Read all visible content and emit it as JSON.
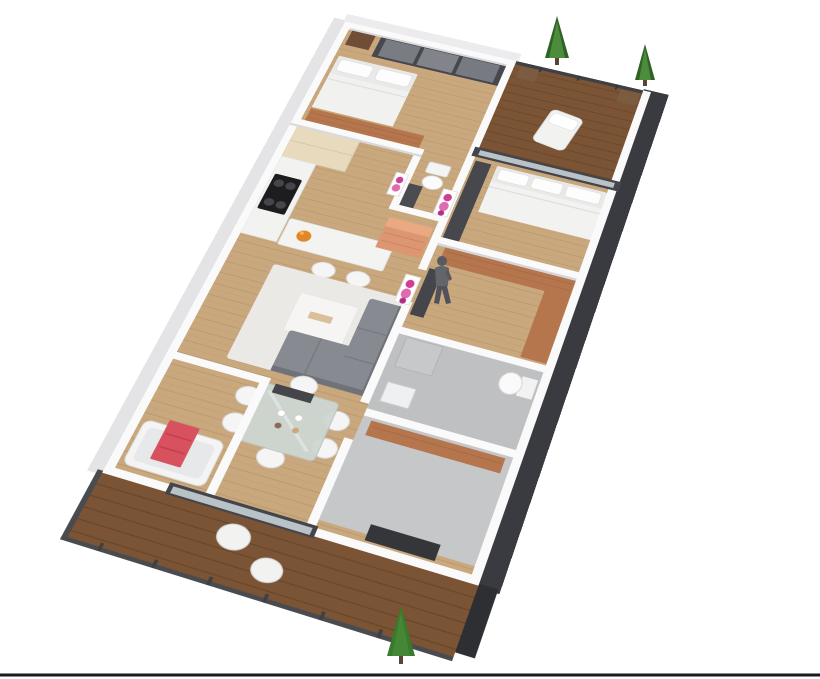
{
  "scene": {
    "type": "isometric-3d-floor-plan-render",
    "background": "#ffffff",
    "description": "Dollhouse-view 3D floor plan of an apartment: open kitchen-living-dining zone, two bedrooms, study, two bathrooms, WC, upper balcony with trees and long lower timber terrace"
  },
  "palette": {
    "floor_wood": "#c9a87e",
    "floor_plank_line": "#a98a62",
    "deck_wood": "#7a5434",
    "deck_plank_line": "#5d3d22",
    "wall_cap": "#fafafa",
    "wall_face_light": "#e4e4e7",
    "wall_face_top": "#ececef",
    "exterior_dark": "#3a3b40",
    "deck_fascia_dark": "#2e2f33",
    "railing_dark": "#4a4b4f",
    "panel_dark": "#47484d",
    "mirror_gray": "#7a7c84",
    "glass_pale": "#cdd8dd",
    "door_frame_dark": "#44454a",
    "gray_floor": "#bfc0c2",
    "gray_floor_2": "#c6c7c9",
    "cream_cabinet": "#e7dabd",
    "counter_white": "#f2f2f1",
    "cooktop_black": "#1d1d1f",
    "burner_gray": "#45464a",
    "island_white": "#f3f3f2",
    "rug": "#ebe9e5",
    "coffee_table": "#f6f5f3",
    "table_deco": "#d9c09a",
    "sofa_gray": "#878a90",
    "sofa_gray_dark": "#6f7278",
    "dining_glass": "#cdd7d2",
    "chair_white": "#f5f5f5",
    "copper_sideboard": "#dd9672",
    "copper_sideboard_top": "#eaa981",
    "art_magenta": "#cf3f96",
    "art_magenta_2": "#e06ab0",
    "art_magenta_3": "#b12f84",
    "towel_red": "#d8515f",
    "towel_red_dark": "#c23f4e",
    "tub_white": "#f4f4f4",
    "wood_desk": "#b5764d",
    "wood_desk_grain": "#9a5f3c",
    "bed_white": "#f1f1f0",
    "bed_base": "#e9e9e8",
    "pillow_white": "#fdfdfd",
    "tree_green": "#3a7a2b",
    "tree_green_dark": "#2f6325",
    "tree_green_light": "#4f9040",
    "trunk_brown": "#5a4632",
    "person_gray": "#63646c",
    "person_dark": "#50515a",
    "fruit_orange": "#e08728",
    "bottom_line": "#191a1e"
  },
  "rooms": [
    {
      "name": "bedroom-top",
      "floor": "wood",
      "furniture": [
        "double-bed",
        "mirrored-wardrobe",
        "bedside-table"
      ]
    },
    {
      "name": "study-nook",
      "floor": "wood",
      "furniture": [
        "wood-desk",
        "wardrobe",
        "wall-sink"
      ]
    },
    {
      "name": "wc",
      "floor": "wood",
      "furniture": [
        "toilet"
      ]
    },
    {
      "name": "balcony-upper",
      "floor": "deck",
      "furniture": [
        "lounge-chair",
        "potted-tree",
        "potted-tree",
        "glass-railing"
      ]
    },
    {
      "name": "bedroom-right",
      "floor": "wood",
      "furniture": [
        "double-bed",
        "wardrobe",
        "sliding-glass-door"
      ]
    },
    {
      "name": "study-right",
      "floor": "wood",
      "furniture": [
        "l-shaped-wood-desk",
        "wardrobe"
      ]
    },
    {
      "name": "bathroom-right",
      "floor": "gray",
      "furniture": [
        "toilet",
        "shower",
        "sink"
      ]
    },
    {
      "name": "utility-room",
      "floor": "gray",
      "furniture": [
        "wood-counter",
        "dark-door"
      ]
    },
    {
      "name": "kitchen",
      "floor": "wood",
      "furniture": [
        "tall-cream-cabinet",
        "counter",
        "cooktop",
        "sink",
        "island-bar",
        "bar-stool",
        "bar-stool",
        "fruit-bowl"
      ]
    },
    {
      "name": "living-room",
      "floor": "wood",
      "furniture": [
        "area-rug",
        "coffee-table",
        "corner-sofa",
        "copper-sideboard",
        "wall-art",
        "wall-art",
        "wall-art"
      ]
    },
    {
      "name": "dining-area",
      "floor": "wood",
      "furniture": [
        "glass-dining-table",
        "six-white-chairs",
        "sliding-glass-door"
      ]
    },
    {
      "name": "bathroom-left",
      "floor": "wood",
      "furniture": [
        "bathtub",
        "red-towel"
      ]
    },
    {
      "name": "terrace-lower",
      "floor": "deck",
      "furniture": [
        "egg-chair",
        "egg-chair",
        "potted-tree",
        "metal-railing"
      ]
    }
  ],
  "figures": [
    "standing-person"
  ]
}
